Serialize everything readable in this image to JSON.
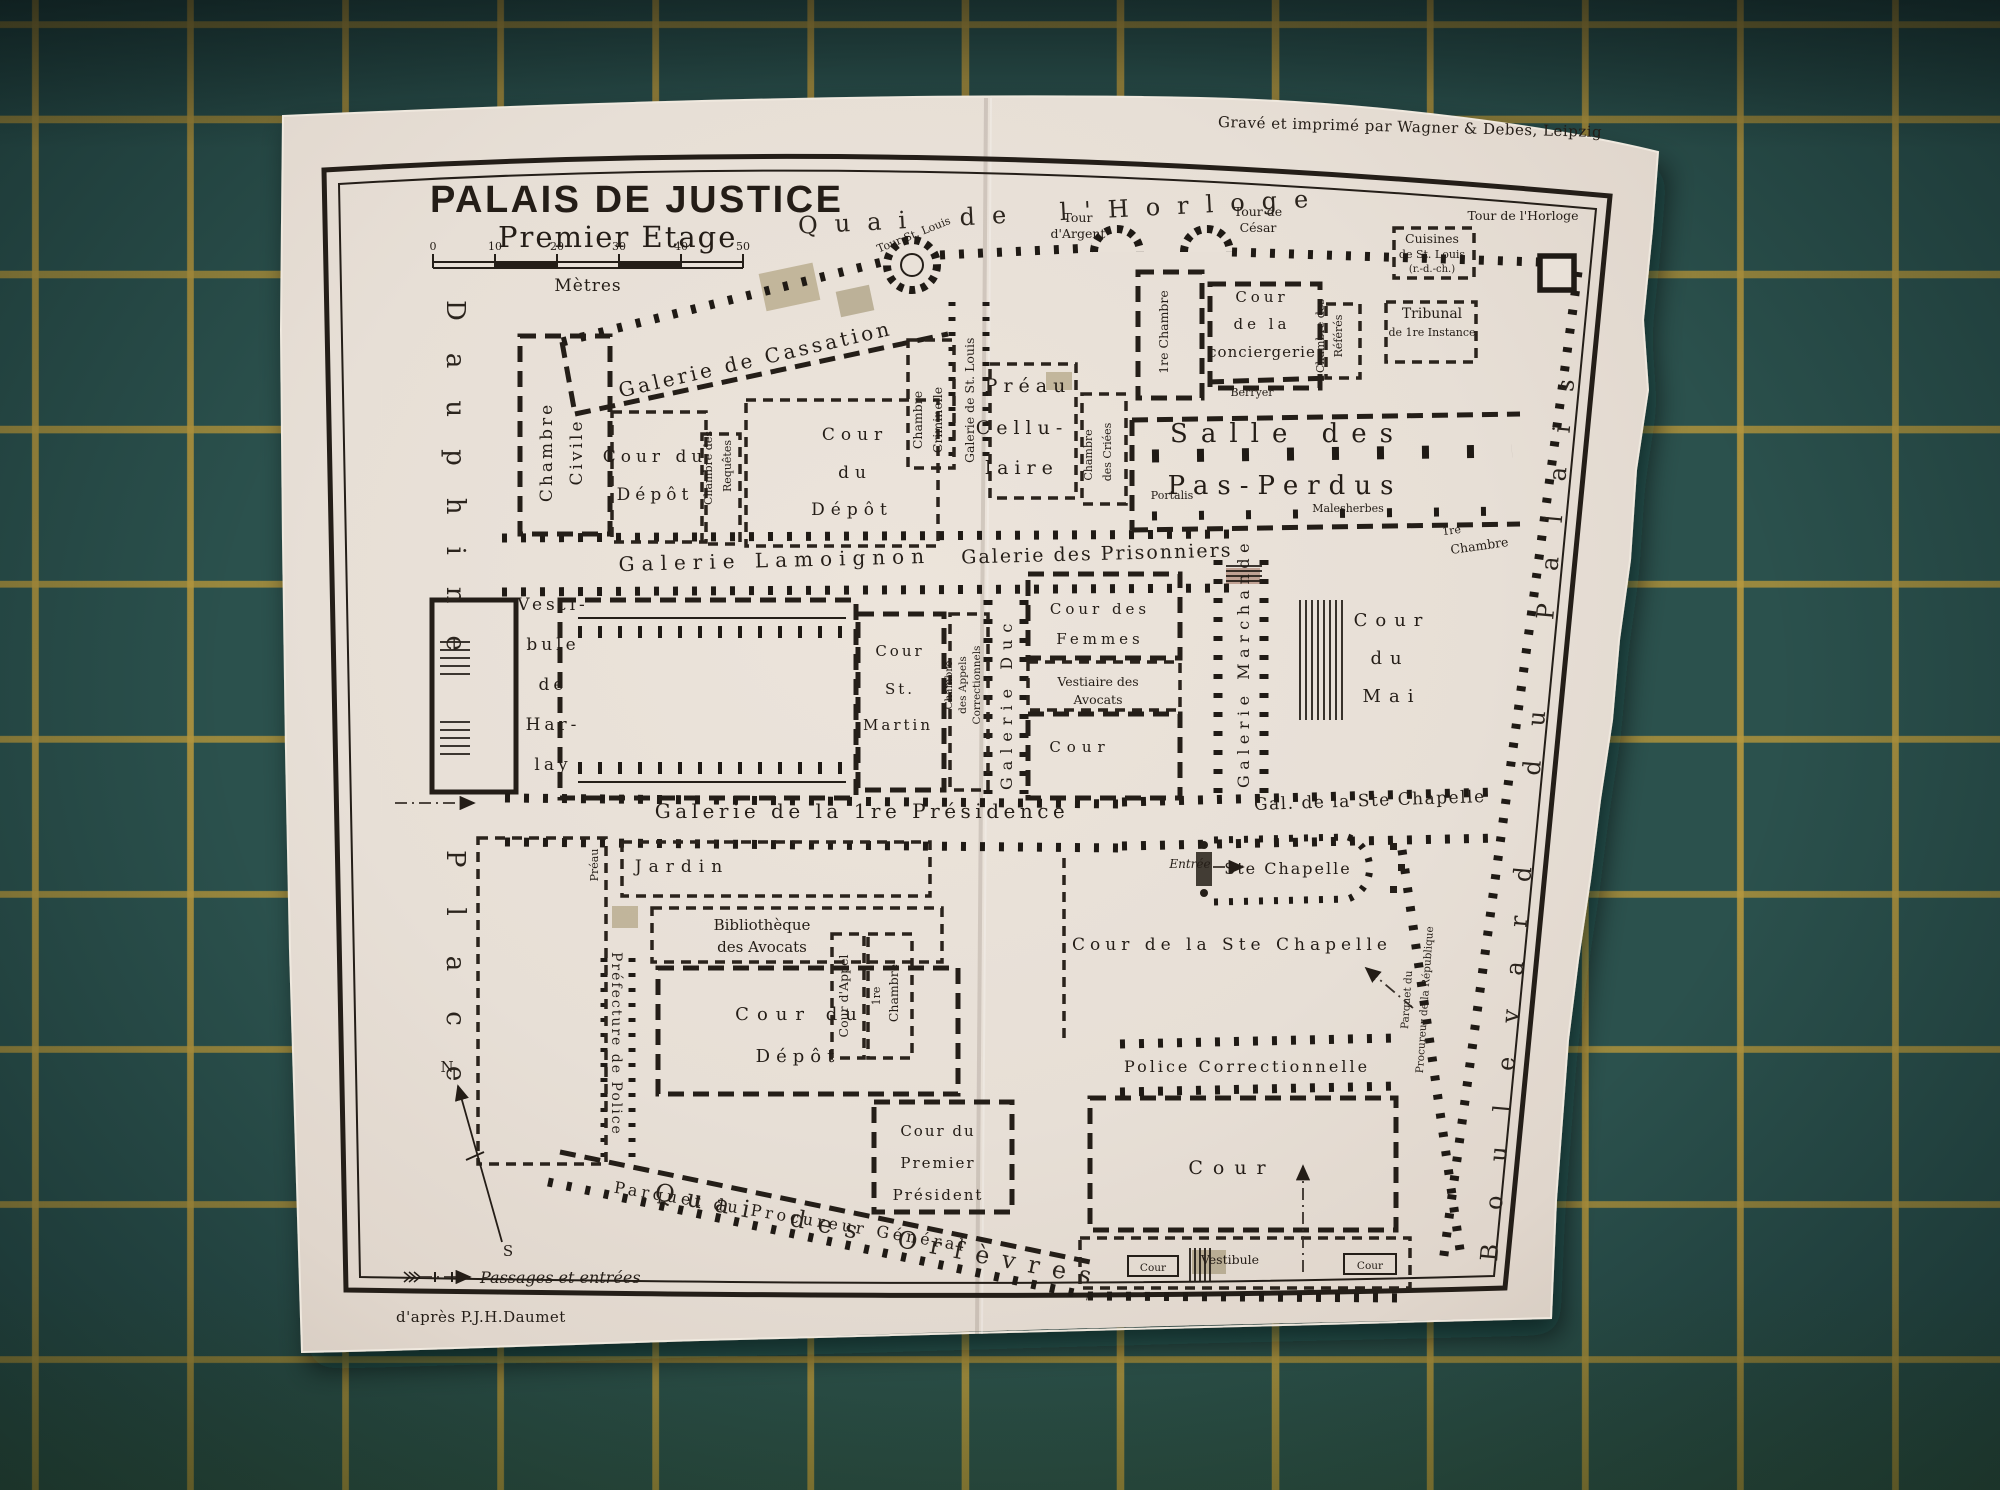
{
  "photo": {
    "mat_color": "#2b514d",
    "grid_color": "#b2953e",
    "paper_color": "#e9e1d8",
    "ink_color": "#241d17"
  },
  "header": {
    "title": "PALAIS DE JUSTICE",
    "subtitle": "Premier Etage",
    "scale_ticks": [
      "0",
      "10",
      "20",
      "30",
      "40",
      "50"
    ],
    "scale_unit": "Mètres",
    "engraver_credit": "Gravé et imprimé par Wagner & Debes, Leipzig",
    "author_credit": "d'après P.J.H.Daumet"
  },
  "legend": {
    "passages": "Passages et entrées",
    "compass_north": "N",
    "compass_south": "S"
  },
  "streets": {
    "quai_horloge": "Quai de l'Horloge",
    "quai_orfevres": "Quai des Orfèvres",
    "dauphine": "Dauphine",
    "place": "Place",
    "boulevard_du_palais": "Boulevard du Palais"
  },
  "galleries": {
    "cassation": "Galerie de Cassation",
    "lamoignon": "Galerie Lamoignon",
    "prisonniers": "Galerie des Prisonniers",
    "presidence": "Galerie de la 1re Présidence",
    "ste_chapelle": "Gal. de la Ste Chapelle",
    "marchande": "Galerie Marchande",
    "duc": "Galerie Duc",
    "st_louis": "Galerie de St. Louis"
  },
  "towers": {
    "tour_st_louis": "Tour St. Louis",
    "tour_d_argent": [
      "Tour",
      "d'Argent"
    ],
    "tour_de_cesar": [
      "Tour de",
      "César"
    ],
    "tour_de_l_horloge": "Tour de l'Horloge"
  },
  "rooms": {
    "chambre_civile": [
      "Chambre",
      "Civile"
    ],
    "chambre_des_requetes": [
      "Chambre des",
      "Requêtes"
    ],
    "cour_du_depot_nw": [
      "Cour du",
      "Dépôt"
    ],
    "cour_du_depot_n": [
      "Cour",
      "du",
      "Dépôt"
    ],
    "chambre_criminelle": [
      "Chambre",
      "Criminelle"
    ],
    "preau_cellulaire": [
      "Préau",
      "Cellu-",
      "laire"
    ],
    "chambre_des_criees": [
      "Chambre",
      "des Criées"
    ],
    "premiere_chambre_n": "1re Chambre",
    "cour_de_la_conciergerie": [
      "Cour",
      "de la",
      "conciergerie"
    ],
    "chambre_des_referes": [
      "Chambre des",
      "Référés"
    ],
    "tribunal_de_1re_instance": [
      "Tribunal",
      "de 1re Instance"
    ],
    "cuisines_de_st_louis": [
      "Cuisines",
      "de St. Louis",
      "(r.-d.-ch.)"
    ],
    "salle_des_pas_perdus": [
      "Salle des",
      "Pas-Perdus"
    ],
    "premiere_chambre_e": [
      "1re",
      "Chambre"
    ],
    "vestibule_de_harlay": [
      "Vesti-",
      "bule",
      "de",
      "Har-",
      "lay"
    ],
    "cour_st_martin": [
      "Cour",
      "St.",
      "Martin"
    ],
    "chambre_des_appels": [
      "Chambre",
      "des Appels",
      "Correctionnels"
    ],
    "cour_des_femmes": [
      "Cour des",
      "Femmes"
    ],
    "vestiaire_des_avocats": [
      "Vestiaire des",
      "Avocats"
    ],
    "cour_centre": "Cour",
    "cour_du_mai": [
      "Cour",
      "du",
      "Mai"
    ],
    "jardin": "Jardin",
    "preau_ouest": "Préau",
    "bibliotheque_des_avocats": [
      "Bibliothèque",
      "des Avocats"
    ],
    "cour_du_depot_s": [
      "Cour du",
      "Dépôt"
    ],
    "cour_d_appel": "Cour d'Appel",
    "premiere_chambre_s": [
      "1re",
      "Chambre"
    ],
    "prefecture_de_police": "Préfecture de Police",
    "cour_du_premier_president": [
      "Cour du",
      "Premier",
      "Président"
    ],
    "parquet_du_procureur_general": "Parquet du Procureur Général",
    "parquet_du_procureur_republique": [
      "Parquet du",
      "Procureur de la République"
    ],
    "ste_chapelle": "Ste Chapelle",
    "cour_de_la_ste_chapelle": "Cour de la Ste Chapelle",
    "police_correctionnelle": "Police Correctionnelle",
    "cour_sud": "Cour",
    "vestibule_sud": "Vestibule",
    "cour_petite_ouest": "Cour",
    "cour_petite_est": "Cour"
  },
  "names": {
    "berryer": "Berryer",
    "portalis": "Portalis",
    "malesherbes": "Malesherbes",
    "entree": "Entrée"
  }
}
